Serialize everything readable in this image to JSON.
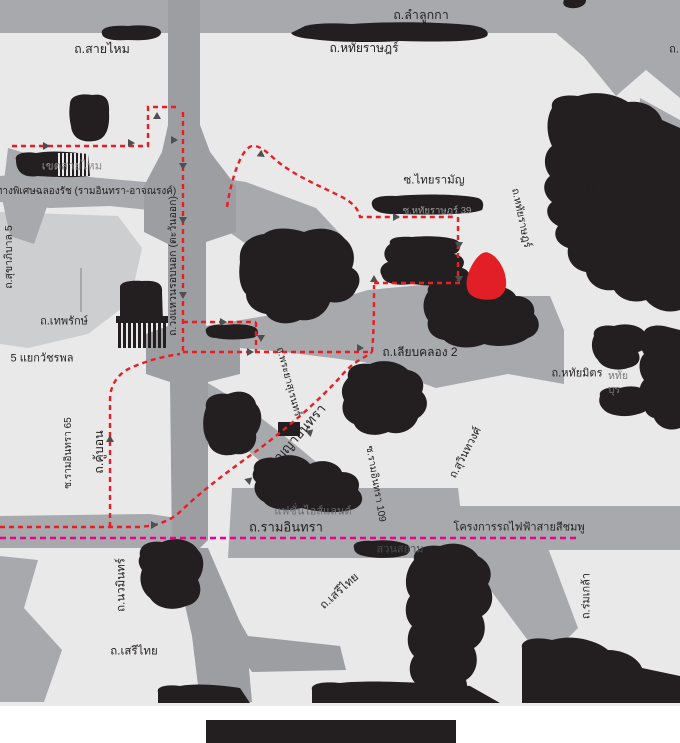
{
  "title": "directions-map",
  "colors": {
    "bg": "#e9e9ea",
    "road": "#a7a9ac",
    "roadDark": "#9c9ea1",
    "roadLight": "#cdced0",
    "black": "#231f20",
    "route": "#ed1c24",
    "pink": "#ec008c",
    "marker": "#e21f26",
    "label": "#231f20",
    "arrow": "#4d4f51"
  },
  "map": {
    "width": 680,
    "height": 743,
    "destination_marker": {
      "shape": "red-blob",
      "cx": 487,
      "cy": 276
    },
    "route_style": "red-dashed-with-arrows",
    "rail_project_style": "pink-dashed"
  },
  "labels": [
    {
      "id": "lamlukka",
      "text": "ถ.ลำลูกกา",
      "cx": 421,
      "cy": 15,
      "size": 12.5
    },
    {
      "id": "saimai",
      "text": "ถ.สายไหม",
      "cx": 102,
      "cy": 49,
      "size": 12.5
    },
    {
      "id": "hathairat-top",
      "text": "ถ.หทัยราษฎร์",
      "cx": 364,
      "cy": 48,
      "size": 12
    },
    {
      "id": "khet-saimai",
      "text": "เขตสายไหม",
      "cx": 72,
      "cy": 167,
      "size": 11.5,
      "color": "#8a8c8f"
    },
    {
      "id": "chalongrat-expressway",
      "text": "ทางพิเศษฉลองรัช (รามอินทรา-อาจณรงค์)",
      "cx": 86,
      "cy": 192,
      "size": 10
    },
    {
      "id": "sukhaphiban-5",
      "text": "ถ.สุขาภิบาล 5",
      "cx": 9,
      "cy": 257,
      "size": 10.5,
      "rotate": -90
    },
    {
      "id": "thepharak",
      "text": "ถ.เทพรักษ์",
      "cx": 64,
      "cy": 322,
      "size": 11
    },
    {
      "id": "wacharaphon",
      "text": "5 แยกวัชรพล",
      "cx": 42,
      "cy": 359,
      "size": 11
    },
    {
      "id": "ring-road-east",
      "text": "ถ.วงแหวนรอบนอก (ตะวันออก)",
      "cx": 173,
      "cy": 266,
      "size": 10.5,
      "rotate": -90
    },
    {
      "id": "thairaman",
      "text": "ซ.ไทยรามัญ",
      "cx": 434,
      "cy": 181,
      "size": 11.5
    },
    {
      "id": "hathairat-39",
      "text": "ซ.หทัยราษฎร์ 39",
      "cx": 437,
      "cy": 211,
      "size": 9.5,
      "color": "#9b9da0"
    },
    {
      "id": "hathairat-diag",
      "text": "ถ.หทัยราษฎร์",
      "cx": 521,
      "cy": 218,
      "size": 10.5,
      "rotate": 78
    },
    {
      "id": "nimitmai",
      "text": "ถ.นิมิตรใหม่",
      "cx": 592,
      "cy": 202,
      "size": 10.5,
      "rotate": 78
    },
    {
      "id": "liab-khlong-2",
      "text": "ถ.เลียบคลอง 2",
      "cx": 420,
      "cy": 352,
      "size": 12
    },
    {
      "id": "hathaimit",
      "text": "ถ.หทัยมิตร",
      "cx": 577,
      "cy": 374,
      "size": 11
    },
    {
      "id": "phraya-suren",
      "text": "ถ.พระยาสุเรนทร์",
      "cx": 288,
      "cy": 382,
      "size": 10,
      "rotate": 75
    },
    {
      "id": "panya-intra",
      "text": "ถ.ปัญญาอินทรา",
      "cx": 293,
      "cy": 441,
      "size": 13.5,
      "rotate": -49
    },
    {
      "id": "ramintra-109",
      "text": "ซ.รามอินทรา 109",
      "cx": 375,
      "cy": 484,
      "size": 10,
      "rotate": 80
    },
    {
      "id": "fashion-island",
      "text": "แฟชั่นไอส์แลนด์",
      "cx": 313,
      "cy": 512,
      "size": 11,
      "color": "#6d6e71"
    },
    {
      "id": "ramintra",
      "text": "ถ.รามอินทรา",
      "cx": 286,
      "cy": 527,
      "size": 13
    },
    {
      "id": "pink-line-project",
      "text": "โครงการรถไฟฟ้าสายสีชมพู",
      "cx": 519,
      "cy": 528,
      "size": 11
    },
    {
      "id": "suan-siam",
      "text": "สวนสยาม",
      "cx": 400,
      "cy": 550,
      "size": 11,
      "color": "#4a4b4d"
    },
    {
      "id": "ramintra-65",
      "text": "ซ.รามอินทรา 65",
      "cx": 69,
      "cy": 453,
      "size": 10,
      "rotate": -90
    },
    {
      "id": "khubon",
      "text": "ถ.คู้บอน",
      "cx": 99,
      "cy": 452,
      "size": 12.5,
      "rotate": -90
    },
    {
      "id": "nawamin",
      "text": "ถ.นวมินทร์",
      "cx": 122,
      "cy": 585,
      "size": 11.5,
      "rotate": -90
    },
    {
      "id": "serithai-west",
      "text": "ถ.เสรีไทย",
      "cx": 134,
      "cy": 652,
      "size": 11.5
    },
    {
      "id": "serithai-east",
      "text": "ถ.เสรีไทย",
      "cx": 340,
      "cy": 592,
      "size": 11.5,
      "rotate": -42
    },
    {
      "id": "suwinthawong",
      "text": "ถ.สุวินทวงศ์",
      "cx": 466,
      "cy": 453,
      "size": 11,
      "rotate": -62
    },
    {
      "id": "romklao",
      "text": "ถ.ร่มเกล้า",
      "cx": 587,
      "cy": 596,
      "size": 11,
      "rotate": -90
    },
    {
      "id": "fragment-hathai",
      "text": "หทัย",
      "cx": 618,
      "cy": 376,
      "size": 10.5,
      "color": "#77787b"
    },
    {
      "id": "fragment-buri",
      "text": "บุร",
      "cx": 614,
      "cy": 390,
      "size": 10.5,
      "color": "#77787b"
    },
    {
      "id": "fragment-top-right",
      "text": "ถ.",
      "cx": 674,
      "cy": 50,
      "size": 11
    }
  ]
}
